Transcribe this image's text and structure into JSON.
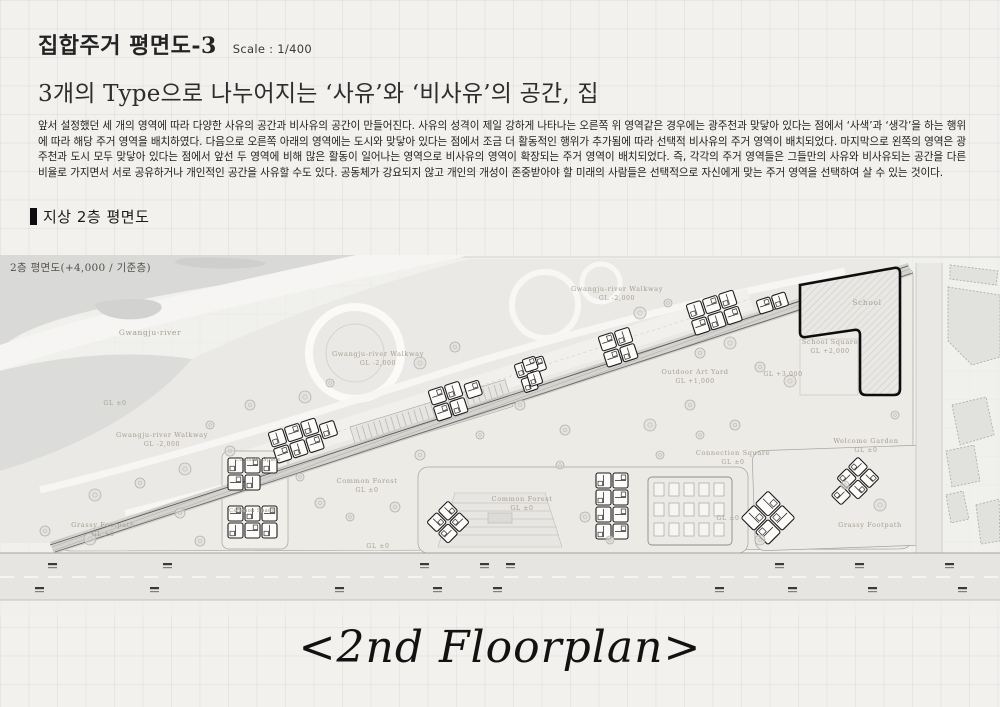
{
  "header": {
    "title": "집합주거 평면도-3",
    "scale": "Scale : 1/400",
    "subtitle": "3개의 Type으로 나누어지는 ‘사유’와 ‘비사유’의 공간, 집",
    "body": "앞서 설정했던 세 개의 영역에 따라 다양한 사유의 공간과 비사유의 공간이 만들어진다. 사유의 성격이 제일 강하게 나타나는 오른쪽 위 영역같은 경우에는 광주천과 맞닿아 있다는 점에서 ‘사색’과 ‘생각’을 하는 행위에 따라 해당 주거 영역을 배치하였다. 다음으로 오른쪽 아래의 영역에는 도시와 맞닿아 있다는 점에서 조금 더 활동적인 행위가 추가됨에 따라 선택적 비사유의 주거 영역이 배치되었다. 마지막으로 왼쪽의 영역은 광주천과 도시 모두 맞닿아 있다는 점에서 앞선 두 영역에 비해 많은 활동이 일어나는 영역으로 비사유의 영역이 확장되는 주거 영역이 배치되었다. 즉, 각각의 주거 영역들은 그들만의 사유와 비사유되는 공간을 다른 비율로 가지면서 서로 공유하거나 개인적인 공간을 사유할 수도 있다. 공동체가 강요되지 않고 개인의 개성이 존중받아야 할 미래의 사람들은 선택적으로 자신에게 맞는 주거 영역을 선택하여 살 수 있는 것이다.",
    "section_title": "지상 2층 평면도"
  },
  "plan": {
    "title": "2층 평면도(+4,000 / 기준층)",
    "river_label": "Gwangju-river",
    "walkway_label": "Gwangju-river Walkway",
    "walkway_level": "GL -2,000",
    "grassy_footpath_label": "Grassy Footpath",
    "ground_level": "GL ±0",
    "common_forest_label": "Common Forest",
    "common_space_label": "Common Space",
    "outdoor_art_yard_label": "Outdoor Art Yard",
    "outdoor_art_yard_level": "GL +1,000",
    "school_label": "School",
    "school_square_label": "School Square",
    "school_square_level": "GL +2,000",
    "school_plaza_level": "GL +3,000",
    "connection_square_label": "Connection Square",
    "welcome_garden_label": "Welcome Garden"
  },
  "footer": {
    "caption": "<2nd Floorplan>"
  },
  "colors": {
    "paper": "#f2f1ee",
    "ink": "#1a1a1a",
    "river_gray": "#d9dad8",
    "label_tan": "#a59e92"
  }
}
